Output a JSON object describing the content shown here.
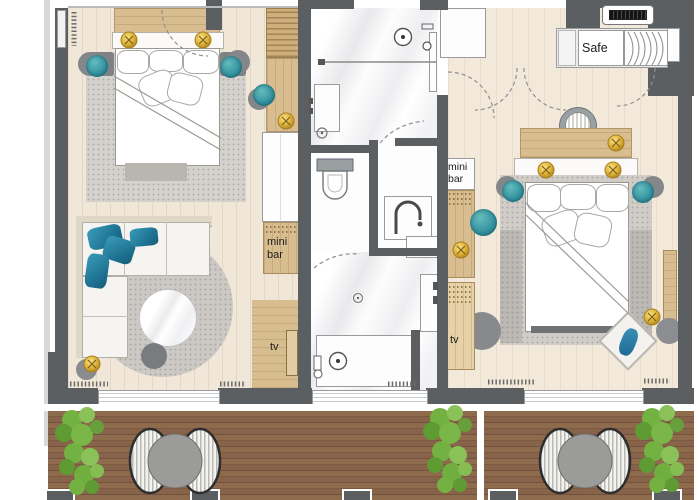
{
  "labels": {
    "safe": "Safe",
    "minibar_left": {
      "line1": "mini",
      "line2": "bar"
    },
    "minibar_right": {
      "line1": "mini",
      "line2": "bar"
    },
    "tv_left": "tv",
    "tv_right": "tv"
  },
  "colors": {
    "wall": "#5c5f62",
    "floor_wood_light": "#f0e7d8",
    "marble": "#f8f8f9",
    "furniture_wood": "#d8bd90",
    "deck_wood": "#8a654a",
    "accent_teal": "#3d9fae",
    "accent_gold": "#e5c247",
    "rug_gray": "#d3d0cc",
    "plant_green": "#74b143",
    "furniture_white": "#ffffff"
  }
}
